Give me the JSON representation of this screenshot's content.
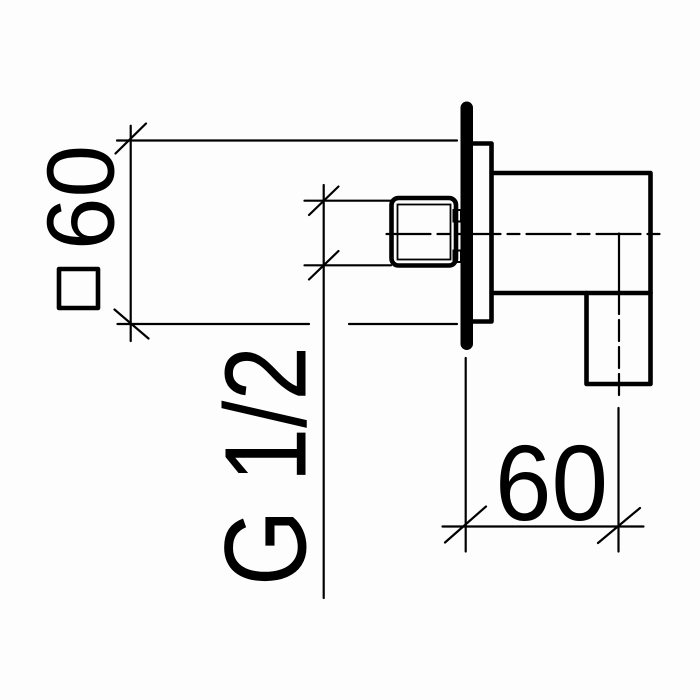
{
  "drawing": {
    "type": "technical-dimension-drawing",
    "colors": {
      "background": "#fdfdfd",
      "line": "#000000",
      "text": "#000000"
    }
  },
  "dimensions": {
    "plate": {
      "value": "60",
      "symbol": "□",
      "label": "□60"
    },
    "thread": {
      "value": "G 1/2"
    },
    "outlet": {
      "value": "60"
    }
  }
}
